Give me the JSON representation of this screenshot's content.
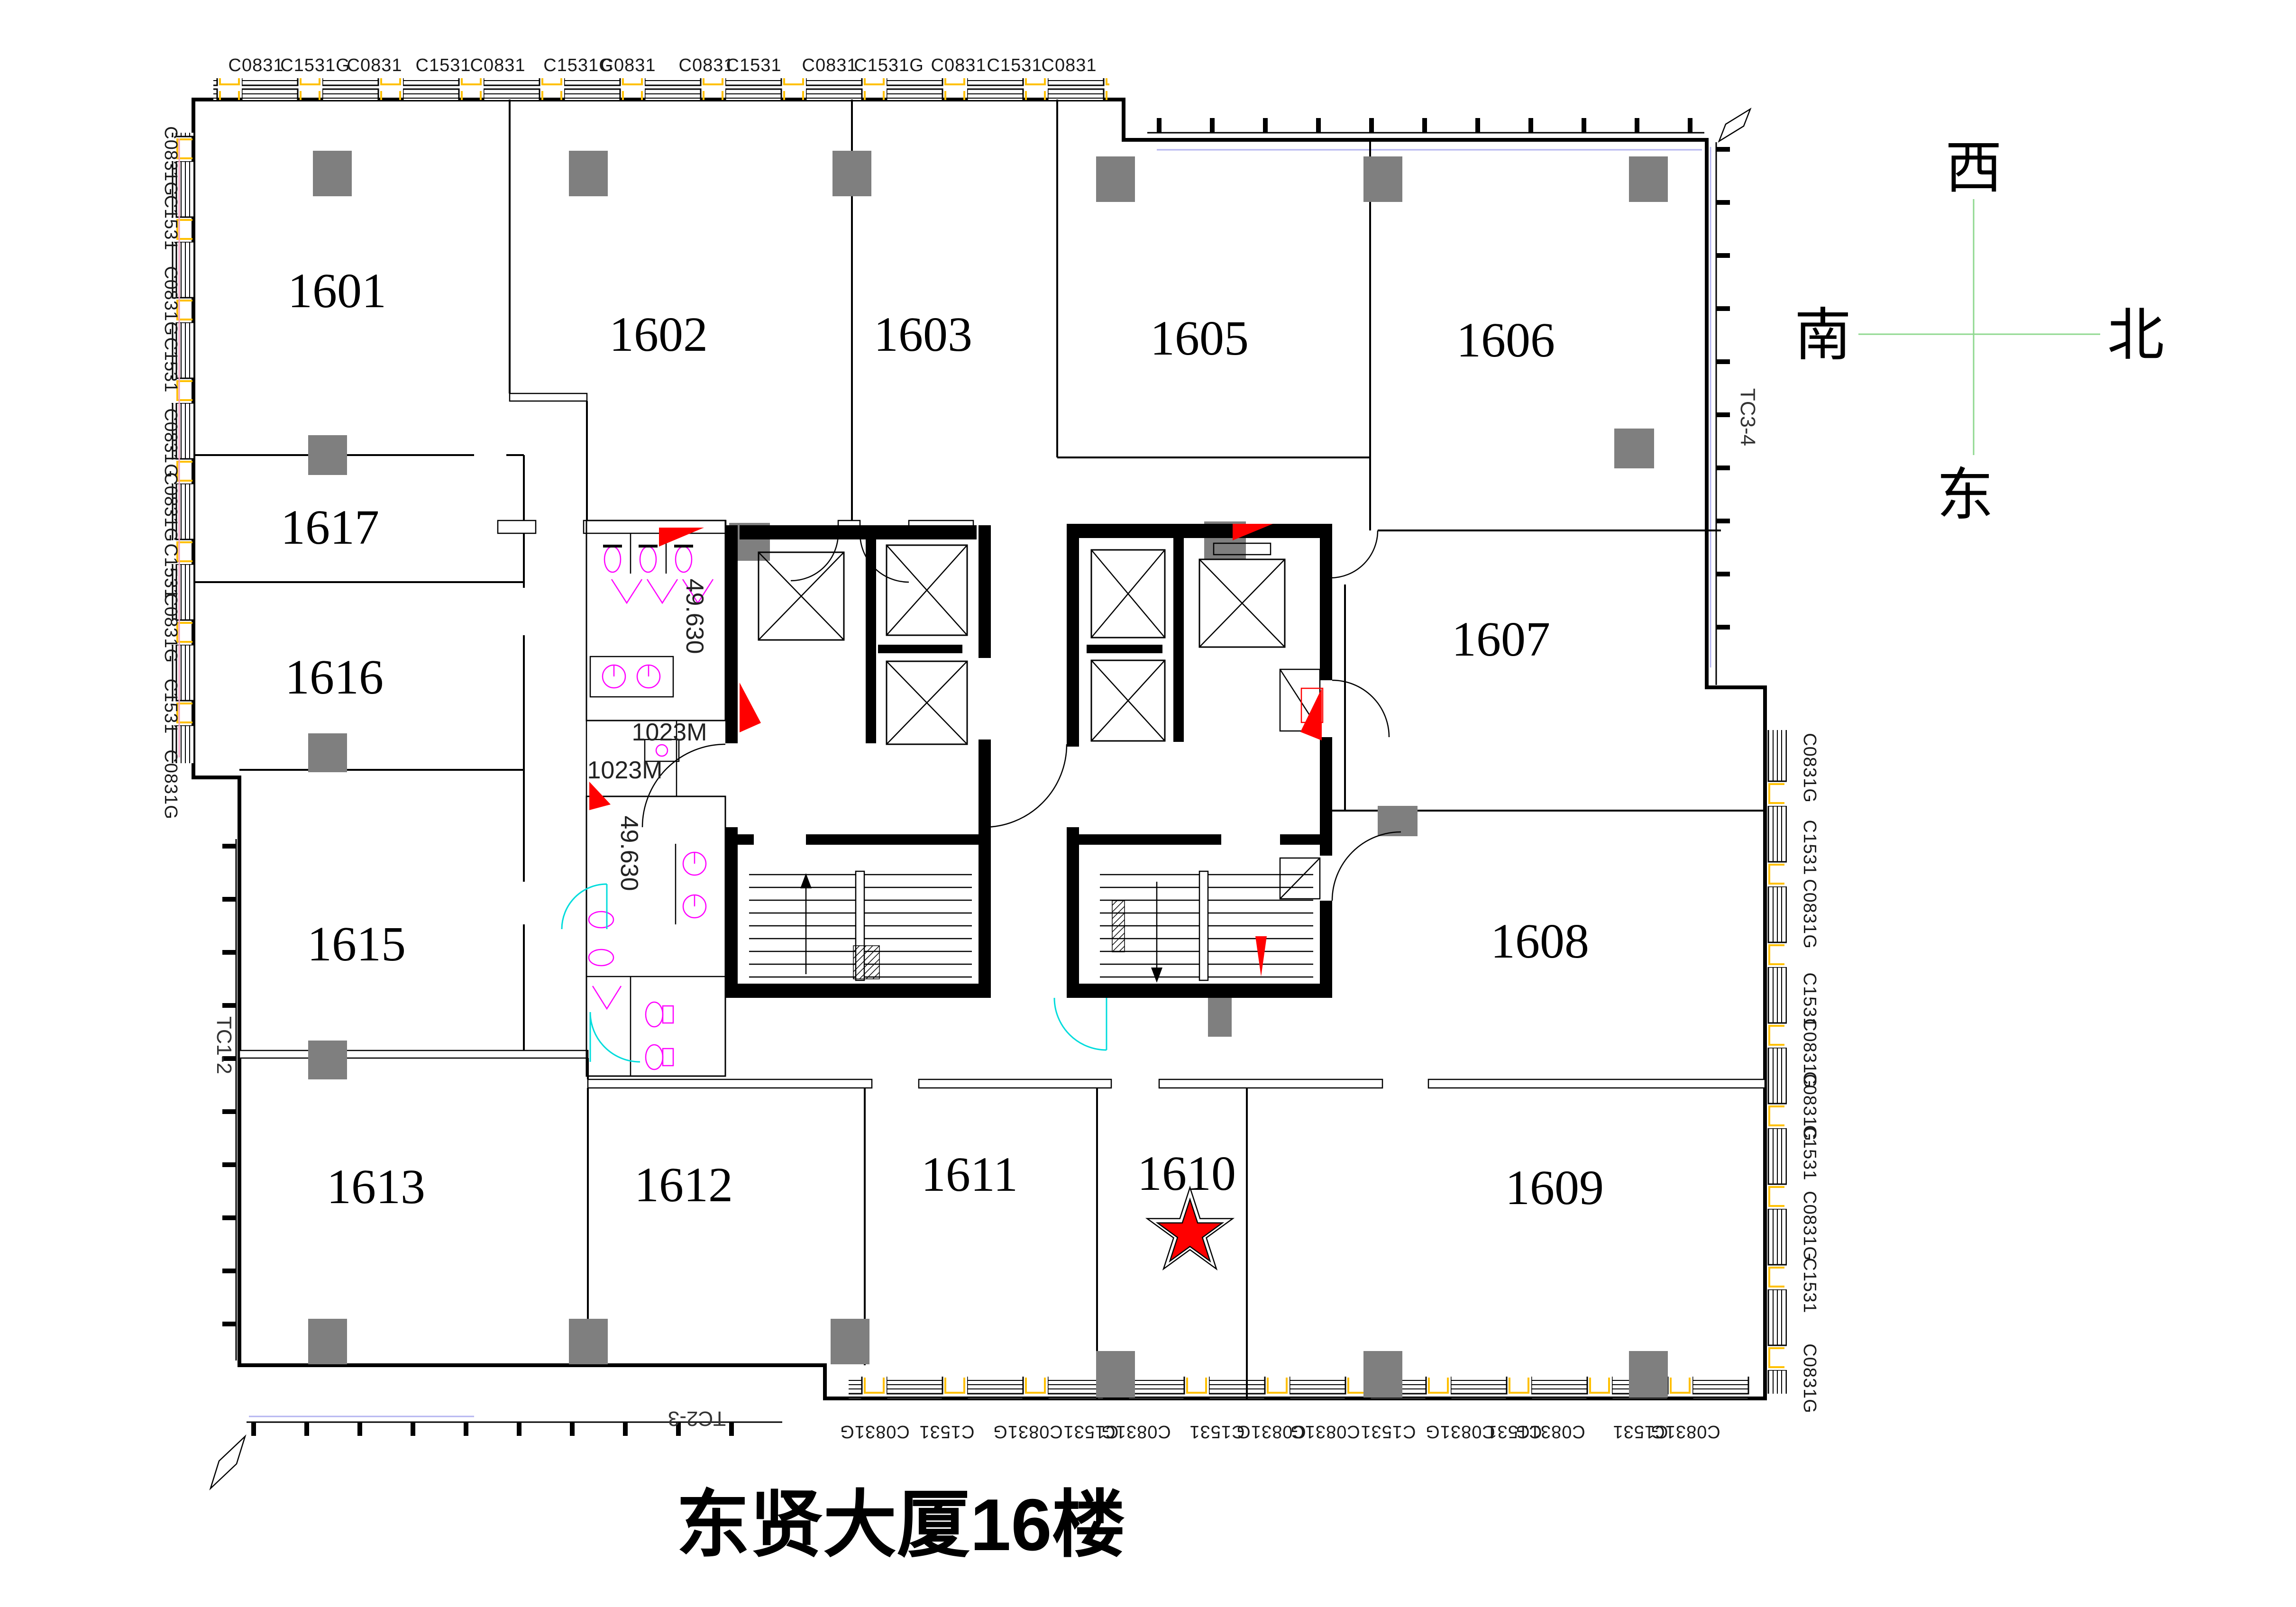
{
  "title": "东贤大厦16楼",
  "compass": {
    "top": "西",
    "left": "南",
    "right": "北",
    "bottom": "东"
  },
  "rooms": [
    "1601",
    "1602",
    "1603",
    "1605",
    "1606",
    "1617",
    "1616",
    "1607",
    "1615",
    "1608",
    "1613",
    "1612",
    "1611",
    "1610",
    "1609"
  ],
  "star_marker": {
    "room": "1610",
    "color": "#ff0000"
  },
  "core_annotations": {
    "level_upper": "49.630",
    "level_lower": "49.630",
    "door_upper": "1023M",
    "door_lower": "1023M"
  },
  "curtain_wall_labels": {
    "left": "TC1-2",
    "bottom": "TC2-3",
    "right": "TC3-4"
  },
  "window_labels": {
    "top": [
      "C0831",
      "C1531G",
      "C0831",
      "C1531",
      "C0831",
      "C1531G",
      "C0831",
      "C0831",
      "C1531",
      "C0831",
      "C1531G",
      "C0831",
      "C1531",
      "C0831"
    ],
    "left": [
      "C0831G",
      "C1531",
      "C0831G",
      "C1531",
      "C0831G",
      "C0831G",
      "C1531",
      "C0831G",
      "C1531",
      "C0831G"
    ],
    "right": [
      "C0831G",
      "C1531",
      "C0831G",
      "C1531",
      "C0831G",
      "C0831G",
      "C1531",
      "C0831G",
      "C1531",
      "C0831G"
    ],
    "bottom": [
      "C0831G",
      "C1531",
      "C0831G",
      "C1531",
      "C0831G",
      "C1531",
      "C0831G",
      "C0831G",
      "C1531",
      "C0831G",
      "C1531",
      "C0831G",
      "C1531",
      "C0831G"
    ]
  },
  "colors": {
    "wall": "#000000",
    "column": "#7f7f7f",
    "fixture": "#ff00ff",
    "window_accent": "#ffc000",
    "door_arc": "#00dcdc",
    "compass_line": "#8fd88f",
    "marker": "#ff0000"
  }
}
